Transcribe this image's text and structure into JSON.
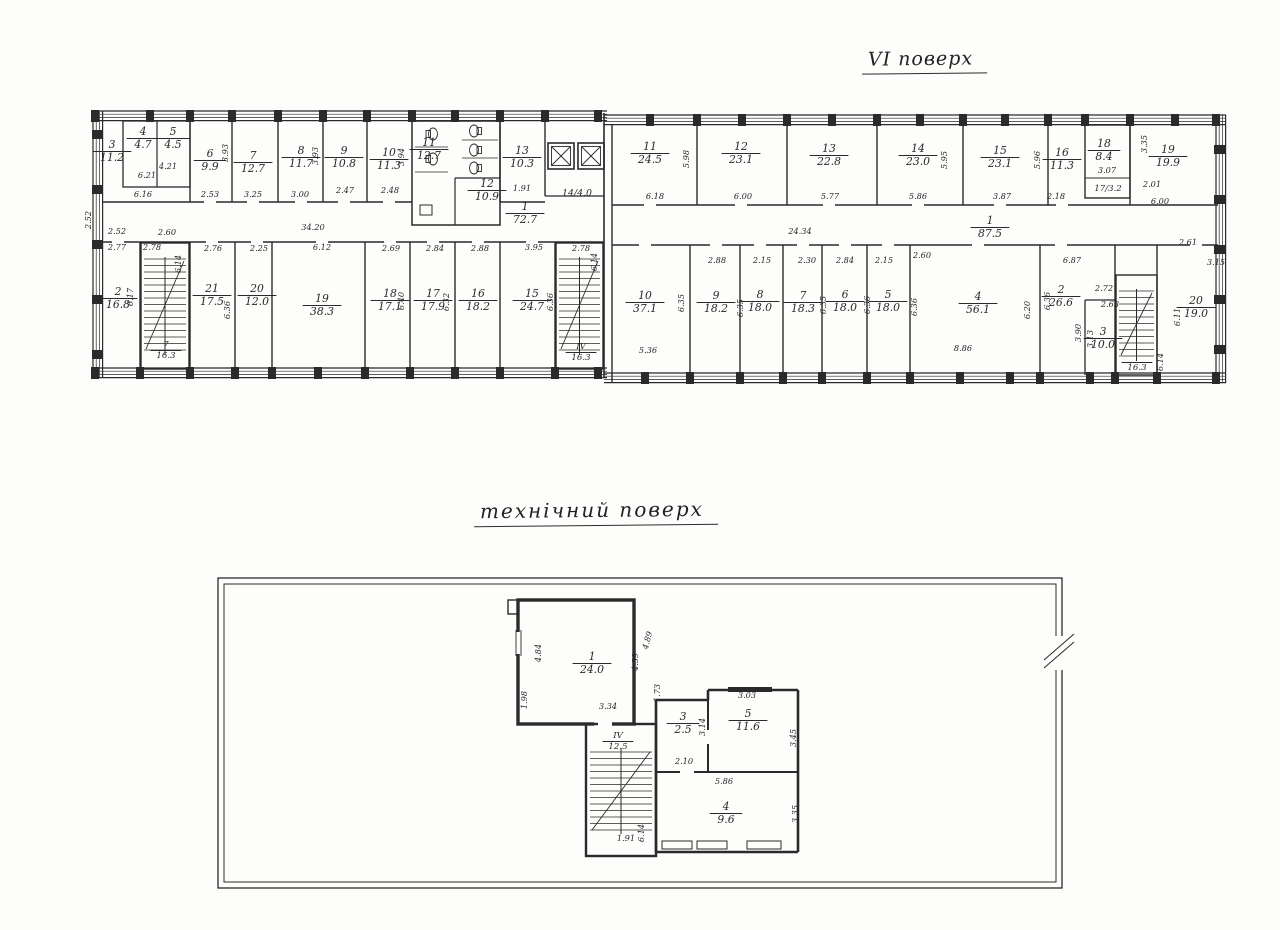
{
  "palette": {
    "ink": "#2a2a2a",
    "paper": "#fdfdfc"
  },
  "floor6": {
    "title": "VI поверх",
    "left_block": {
      "top_rooms": [
        {
          "n": "3",
          "a": "11.2"
        },
        {
          "n": "4",
          "a": "4.7"
        },
        {
          "n": "5",
          "a": "4.5"
        },
        {
          "n": "6",
          "a": "9.9"
        },
        {
          "n": "7",
          "a": "12.7"
        },
        {
          "n": "8",
          "a": "11.7"
        },
        {
          "n": "9",
          "a": "10.8"
        },
        {
          "n": "10",
          "a": "11.3"
        },
        {
          "n": "11",
          "a": "12.7"
        },
        {
          "n": "12",
          "a": "10.9"
        },
        {
          "n": "13",
          "a": "10.3"
        }
      ],
      "elevator_label": "14/4.0",
      "corridor": {
        "n": "1",
        "a": "72.7"
      },
      "bottom_rooms": [
        {
          "n": "2",
          "a": "16.8"
        },
        {
          "n": "7",
          "a": "16.3",
          "stair": true
        },
        {
          "n": "21",
          "a": "17.5"
        },
        {
          "n": "20",
          "a": "12.0"
        },
        {
          "n": "19",
          "a": "38.3"
        },
        {
          "n": "18",
          "a": "17.1"
        },
        {
          "n": "17",
          "a": "17.9"
        },
        {
          "n": "16",
          "a": "18.2"
        },
        {
          "n": "15",
          "a": "24.7"
        },
        {
          "n": "ІV",
          "a": "16.3",
          "stair": true
        }
      ],
      "dims": [
        "6.21",
        "6.16",
        "4.21",
        "2.52",
        "2.52",
        "2.60",
        "2.53",
        "3.25",
        "3.00",
        "2.47",
        "2.48",
        "1.91",
        "34.20",
        "3.93",
        "3.93",
        "3.94",
        "2.77",
        "2.78",
        "2.76",
        "2.25",
        "6.12",
        "2.69",
        "2.84",
        "2.88",
        "3.95",
        "2.78",
        "6.14",
        "6.17",
        "6.36",
        "6.40",
        "6.32",
        "6.36",
        "6.14"
      ]
    },
    "right_block": {
      "top_rooms": [
        {
          "n": "11",
          "a": "24.5"
        },
        {
          "n": "12",
          "a": "23.1"
        },
        {
          "n": "13",
          "a": "22.8"
        },
        {
          "n": "14",
          "a": "23.0"
        },
        {
          "n": "15",
          "a": "23.1"
        },
        {
          "n": "16",
          "a": "11.3"
        },
        {
          "n": "18",
          "a": "8.4"
        },
        {
          "n": "19",
          "a": "19.9"
        }
      ],
      "small_room_label": "17/3.2",
      "corridor": {
        "n": "1",
        "a": "87.5"
      },
      "bottom_rooms": [
        {
          "n": "10",
          "a": "37.1"
        },
        {
          "n": "9",
          "a": "18.2"
        },
        {
          "n": "8",
          "a": "18.0"
        },
        {
          "n": "7",
          "a": "18.3"
        },
        {
          "n": "6",
          "a": "18.0"
        },
        {
          "n": "5",
          "a": "18.0"
        },
        {
          "n": "4",
          "a": "56.1"
        },
        {
          "n": "2",
          "a": "26.6"
        },
        {
          "n": "3",
          "a": "10.0"
        },
        {
          "n": "",
          "a": "16.3",
          "stair": true
        },
        {
          "n": "20",
          "a": "19.0"
        }
      ],
      "dims": [
        "6.18",
        "6.00",
        "5.77",
        "5.86",
        "3.87",
        "2.18",
        "3.07",
        "2.01",
        "6.00",
        "5.98",
        "5.95",
        "5.96",
        "3.35",
        "24.34",
        "2.88",
        "2.15",
        "2.30",
        "2.84",
        "2.15",
        "2.60",
        "6.87",
        "5.36",
        "8.86",
        "2.72",
        "2.63",
        "3.90",
        "3.13",
        "6.11",
        "2.61",
        "3.15",
        "6.35",
        "6.35",
        "6.35",
        "6.36",
        "6.36",
        "6.20",
        "6.36",
        "6.14"
      ]
    }
  },
  "tech_floor": {
    "title": "технічний поверх",
    "rooms": [
      {
        "n": "1",
        "a": "24.0"
      },
      {
        "n": "ІV",
        "a": "12.5",
        "stair": true
      },
      {
        "n": "3",
        "a": "2.5"
      },
      {
        "n": "5",
        "a": "11.6"
      },
      {
        "n": "4",
        "a": "9.6"
      }
    ],
    "dims": [
      "4.84",
      "4.39",
      "4.89",
      "1.98",
      "3.34",
      "1.91",
      "6.14",
      "1.73",
      "2.10",
      "3.14",
      "3.03",
      "3.45",
      "5.86",
      "3.35"
    ]
  }
}
